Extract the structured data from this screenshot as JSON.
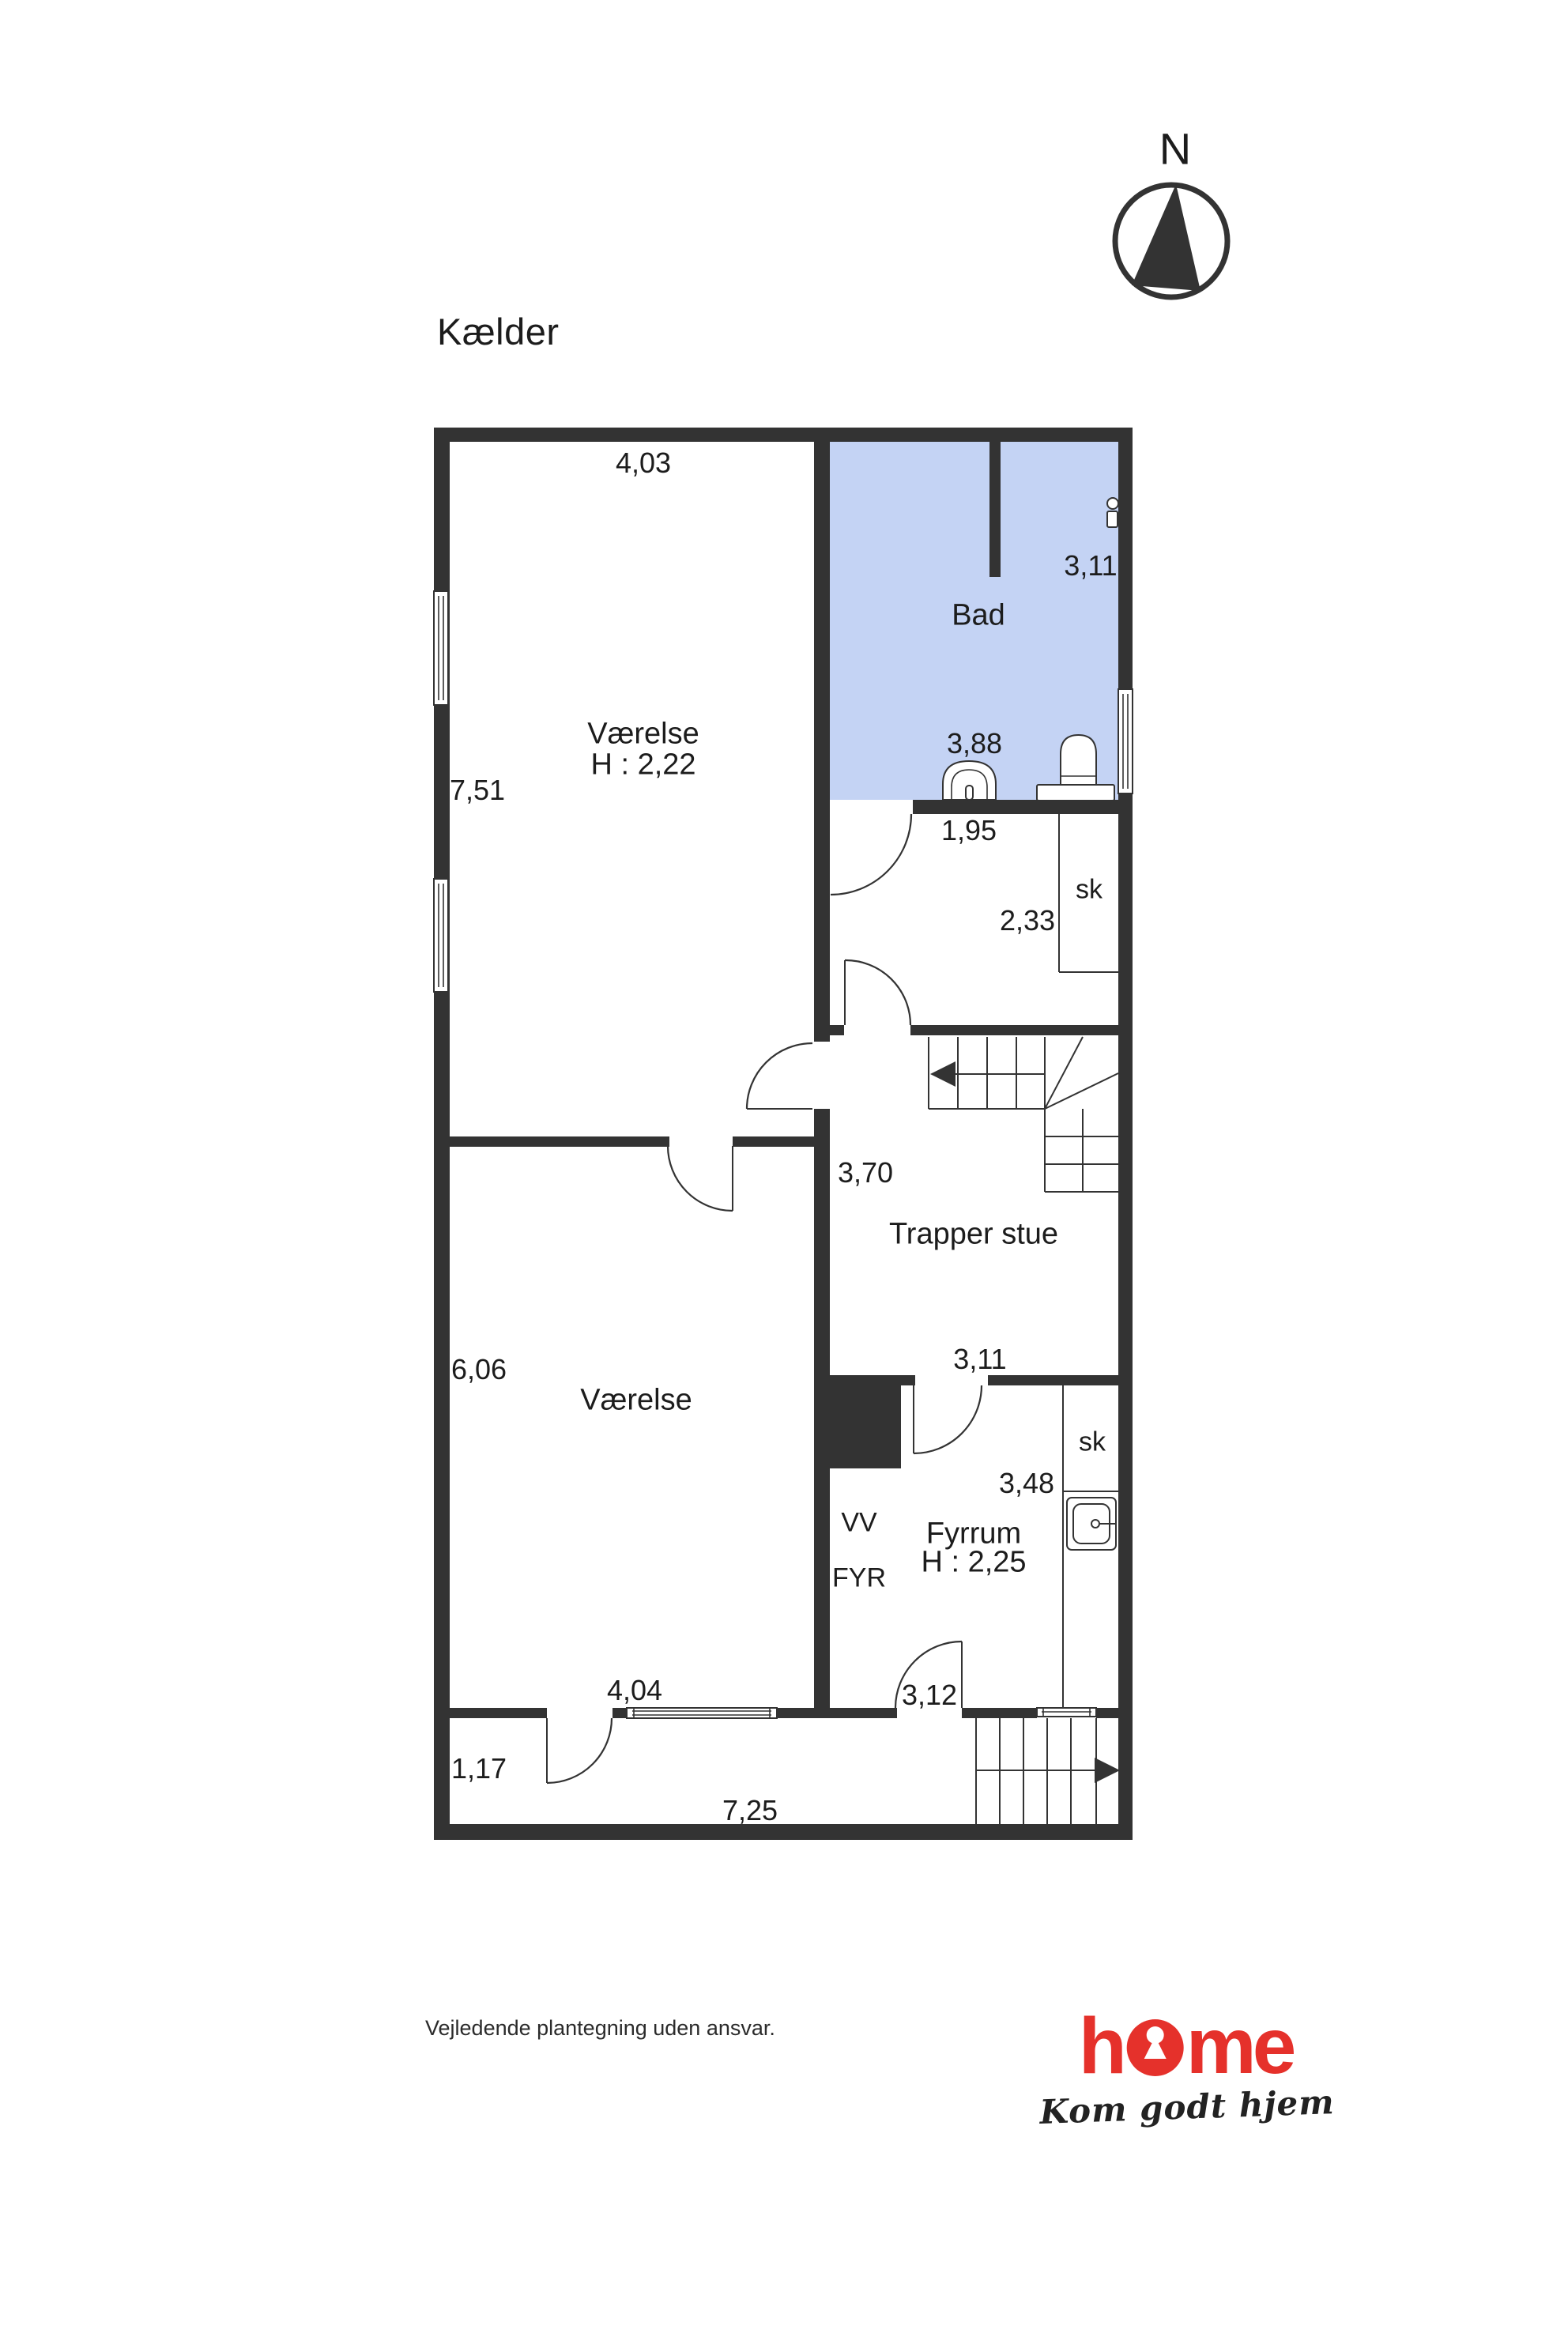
{
  "page": {
    "title": "Kælder",
    "compass_label": "N",
    "disclaimer": "Vejledende plantegning uden ansvar."
  },
  "colors": {
    "wall": "#333333",
    "bath_fill": "#c4d3f4",
    "brand_red": "#e5312b",
    "text": "#1c1c1c"
  },
  "rooms": {
    "vaerelse1": {
      "name": "Værelse",
      "ceiling": "H : 2,22"
    },
    "bad": {
      "name": "Bad"
    },
    "trapper_stue": {
      "name": "Trapper stue"
    },
    "vaerelse2": {
      "name": "Værelse"
    },
    "fyrrum": {
      "name": "Fyrrum",
      "ceiling": "H : 2,25"
    },
    "closet1": {
      "name": "sk"
    },
    "closet2": {
      "name": "sk"
    },
    "vv": {
      "name": "VV"
    },
    "fyr": {
      "name": "FYR"
    }
  },
  "measurements": {
    "m403": "4,03",
    "m311_bad": "3,11",
    "m751": "7,51",
    "m388": "3,88",
    "m195": "1,95",
    "m233": "2,33",
    "m370": "3,70",
    "m311_trapper": "3,11",
    "m606": "6,06",
    "m348": "3,48",
    "m312": "3,12",
    "m404": "4,04",
    "m117": "1,17",
    "m725": "7,25"
  },
  "logo": {
    "brand": "home",
    "brand_pre": "h",
    "brand_post": "me",
    "tagline": "Kom godt hjem"
  }
}
